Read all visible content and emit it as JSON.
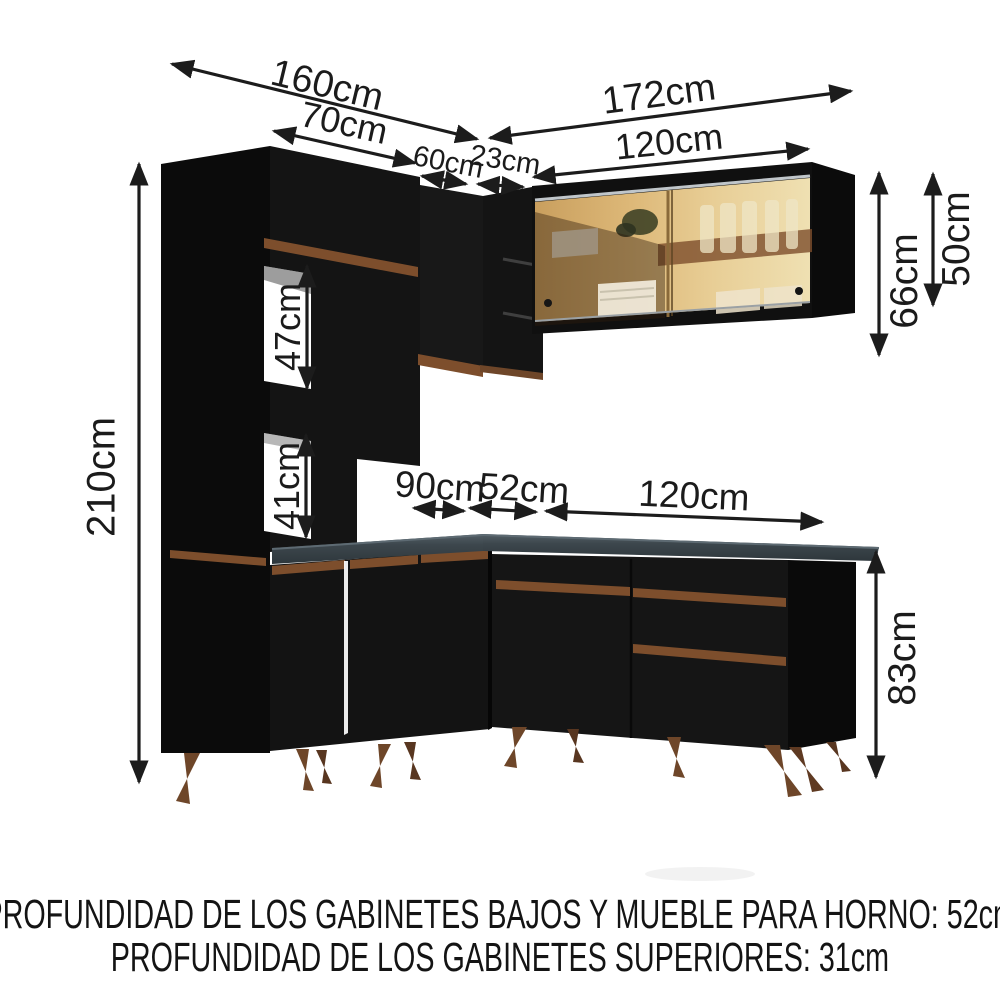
{
  "product": {
    "name": "modular-corner-kitchen-diagram",
    "notes": {
      "line1": "PROFUNDIDAD DE LOS GABINETES BAJOS Y MUEBLE PARA HORNO: 52cm",
      "line2": "PROFUNDIDAD DE LOS GABINETES SUPERIORES: 31cm"
    }
  },
  "dimensions": {
    "left_run_total": "160cm",
    "tall_cabinet_width": "70cm",
    "right_run_total": "172cm",
    "wall_cabinet_width": "120cm",
    "left_wall_cabinet_width": "60cm",
    "corner_shelf_width": "23cm",
    "total_height": "210cm",
    "upper_niche_height": "47cm",
    "lower_niche_height": "41cm",
    "wall_cabinet_height": "66cm",
    "glass_door_height": "50cm",
    "base_cabinet_height": "83cm",
    "left_base_width": "90cm",
    "corner_base_width": "52cm",
    "right_base_width": "120cm"
  },
  "colors": {
    "cabinet_black": "#121212",
    "side_panel_black": "#0b0b0b",
    "handle_brown": "#7d4e2c",
    "leg_brown": "#6e4629",
    "countertop_gray": "#3d474d",
    "glass_amber": "#ddba7e",
    "glass_track_silver": "#c0c6ca",
    "arrow_black": "#1c1c1c"
  }
}
